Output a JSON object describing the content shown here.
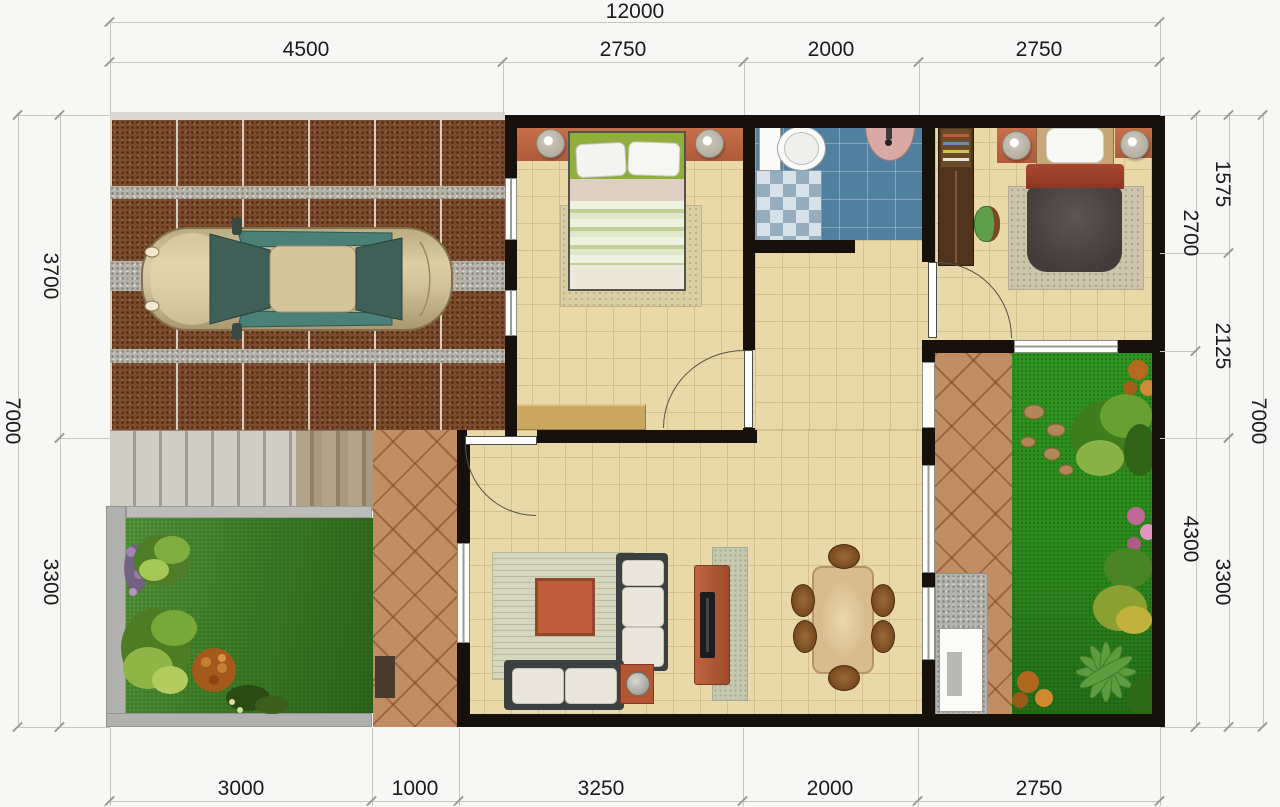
{
  "dimensions": {
    "top": {
      "total": "12000",
      "segments": [
        "4500",
        "2750",
        "2000",
        "2750"
      ]
    },
    "bottom": {
      "segments": [
        "3000",
        "1000",
        "3250",
        "2000",
        "2750"
      ]
    },
    "left": {
      "total": "7000",
      "segments": [
        "3700",
        "3300"
      ]
    },
    "right": {
      "total": "7000",
      "inner_segments": [
        "2700",
        "4300"
      ],
      "outer_segments": [
        "1575",
        "2125",
        "3300"
      ]
    }
  },
  "palette": {
    "wall_black": "#17110b",
    "floor_cream": "#ead9a8",
    "bathroom_blue": "#50809e",
    "terrace_terracotta": "#c18d62",
    "carport_paving_brown": "#7b4b2c",
    "concrete_gray": "#b6b2a9",
    "lawn_green": "#2f8a1f",
    "accent_wall_orange": "#bf6747",
    "car_champagne": "#cfc09a",
    "bed2_blanket": "#4c4442",
    "bed2_fold_red": "#9c3b28",
    "dimension_text": "#1b1b1b"
  },
  "objects": [
    "carport-paving",
    "car",
    "deck-planks",
    "front-garden",
    "rear-garden",
    "terrace-path",
    "living-room-rug",
    "sofa-set",
    "coffee-table",
    "tv-cabinet",
    "dining-set",
    "bedroom-1-bed",
    "bedroom-2-bed",
    "wardrobe",
    "bathroom-toilet",
    "bathroom-sink",
    "shower-checker-tiles",
    "wall-lamps",
    "doors",
    "windows",
    "washing-area"
  ]
}
